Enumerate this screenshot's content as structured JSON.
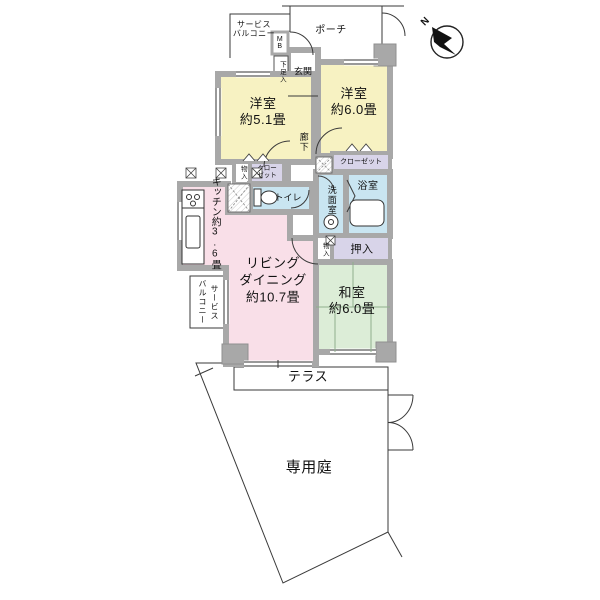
{
  "plan": {
    "compass": {
      "north_letter": "N"
    },
    "labels": {
      "service_balcony_top": "サービス\nバルコニー",
      "mb": "M\nB",
      "porch": "ポーチ",
      "shoe_box": "下足入",
      "entrance": "玄関",
      "western_room_1": "洋室\n約5.1畳",
      "western_room_2": "洋室\n約6.0畳",
      "corridor": "廊下",
      "storage_left": "物入",
      "closet_left": "クロー\nゼット",
      "toilet": "トイレ",
      "kitchen": "キッチン約3.6畳",
      "washroom": "洗面室",
      "bathroom": "浴室",
      "closet_right": "クローゼット",
      "storage_right": "物入",
      "oshiire": "押入",
      "japanese_room": "和室\n約6.0畳",
      "living_dining": "リビング\nダイニング\n約10.7畳",
      "service_balcony_left": "サービス\nバルコニー",
      "terrace": "テラス",
      "private_garden": "専用庭"
    },
    "colors": {
      "western_room": "#f7f2c2",
      "living_dining": "#f9dfe8",
      "japanese_room": "#dcedd7",
      "wet_area": "#c9e5f1",
      "closet": "#d8d4e9",
      "wall": "#a8a8a8",
      "white": "#ffffff"
    }
  }
}
